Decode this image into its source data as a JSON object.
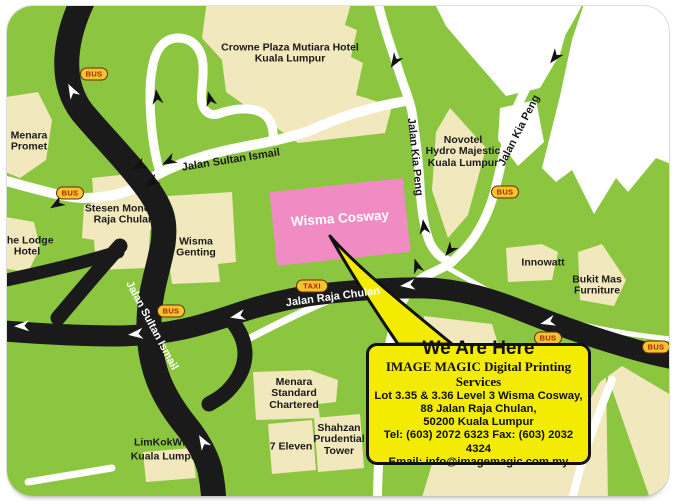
{
  "map": {
    "places": {
      "crowne_plaza": "Crowne Plaza Mutiara Hotel\nKuala Lumpur",
      "menara_promet": "Menara\nPromet",
      "lodge_hotel": "The Lodge\nHotel",
      "stesen_monorel": "Stesen Monorel\nRaja Chulan",
      "wisma_genting": "Wisma\nGenting",
      "wisma_cosway": "Wisma Cosway",
      "novotel": "Novotel\nHydro Majestic\nKuala Lumpur",
      "innowatt": "Innowatt",
      "bukit_mas": "Bukit Mas\nFurniture",
      "menara_standard_chartered": "Menara\nStandard\nChartered",
      "seven_eleven": "7 Eleven",
      "shahzan_prudential": "Shahzan\nPrudential\nTower",
      "limkokwing": "LimKokWing\nKuala Lumpur"
    },
    "roads": {
      "jalan_sultan_ismail": "Jalan Sultan Ismail",
      "jalan_raja_chulan": "Jalan Raja Chulan",
      "jalan_kia_peng": "Jalan Kia Peng"
    },
    "markers": {
      "bus": "BUS",
      "taxi": "TAXI"
    },
    "colors": {
      "map_green": "#8CC640",
      "building_cream": "#F2E8BD",
      "building_white": "#FFFFFF",
      "road_black": "#1A1A1A",
      "wisma_cosway_pink": "#F08CC3",
      "callout_yellow": "#F3EB00",
      "bus_marker_fill": "#F2C433",
      "bus_marker_text": "#B51E00"
    }
  },
  "callout": {
    "title": "We Are Here",
    "company": "IMAGE MAGIC Digital Printing Services",
    "address_line1": "Lot 3.35 & 3.36 Level 3 Wisma Cosway,",
    "address_line2": "88 Jalan Raja Chulan,",
    "address_line3": "50200 Kuala Lumpur",
    "tel_fax": "Tel: (603) 2072 6323 Fax: (603) 2032 4324",
    "email": "Email: info@imagemagic.com.my"
  }
}
